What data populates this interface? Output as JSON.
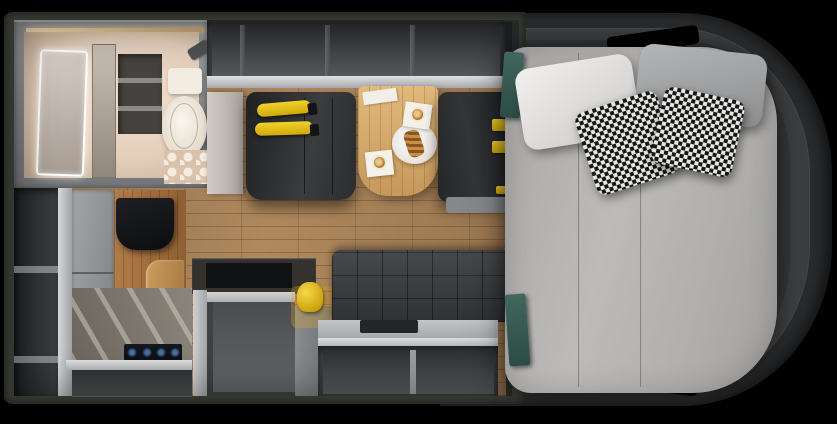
{
  "scene": {
    "type": "rv-camper-van-floorplan-top-view",
    "description": "Photorealistic top-down floor plan of a camper van interior: front bathroom with LED mirror and toilet, overhead storage cabinets, two dark captain chairs with yellow seatbelt straps facing a wood dinette table set with coffee and pastry, galley kitchen with cooktop and yellow kettle, wardrobe, fridge and TV cabinet, tufted sofa bench with under-seat storage, and a rear rounded cab section holding a large gray bed with white, gray and houndstooth pillows and teal towels"
  },
  "palette": {
    "background": "#000000",
    "wall": "#363931",
    "cabBody": "#292b2d",
    "cabInner": "#3a3c3e",
    "mattress": "#b3b2b0",
    "pillowWhite": "#eceaea",
    "pillowGray": "#a4a6a8",
    "houndsDark": "#161616",
    "houndsLight": "#e6e6e4",
    "towelTeal": "#365c56",
    "floorWood": "#a17d54",
    "tableWood": "#d3a76c",
    "chairDark": "#26282a",
    "accentYellow": "#e8c414",
    "sofaDark": "#3b3d3f",
    "cabinetGray": "#3e4043",
    "trimLight": "#d5d6d8",
    "bathroomFloor": "#e7d4c4",
    "bathroomFrame": "#8b8e90",
    "toiletWhite": "#f4efe7",
    "cooktopBlue": "#4a6fa8",
    "fridgeGray": "#97999c"
  },
  "objects": {
    "bathroom": "Wet bath with LED mirror, toilet and hex-tile shower floor",
    "overheadCabinet": "Open overhead storage cabinets",
    "chairLeft": "Captain chair with yellow seatbelt straps",
    "chairRight": "Captain chair with yellow belt tabs",
    "table": "Wood dinette table with coffee cups and pastry plate",
    "sofa": "Tufted charcoal sofa bench with storage below",
    "kitchen": "Galley kitchen counter with gas cooktop and sink covers",
    "kettle": "Yellow kettle on counter",
    "fridge": "Gray refrigerator",
    "tvCabinet": "Wood cabinet column with TV screen",
    "wardrobe": "Open wardrobe shelving",
    "bed": "Rear bed with mattress, pillows and houndstooth cushions",
    "cab": "Rounded van body end with window cutouts",
    "towels": "Teal towels at head and foot of bed"
  }
}
